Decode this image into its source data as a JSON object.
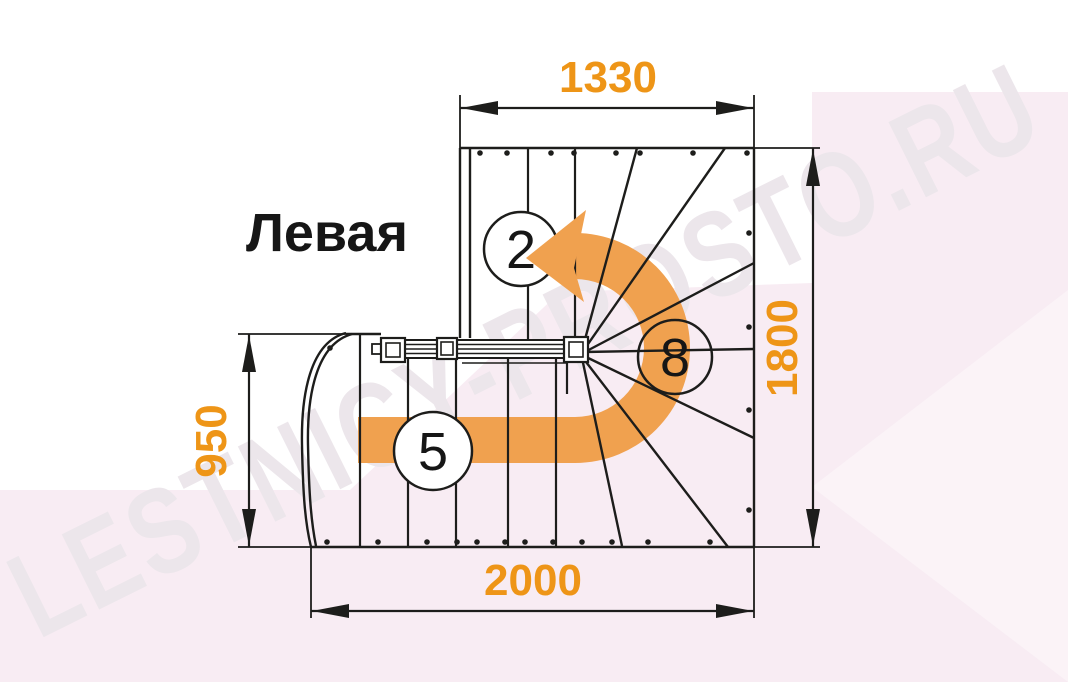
{
  "watermark": {
    "text": "LESTNICY-PROSTO.RU",
    "color": "#ece6eb"
  },
  "drawing": {
    "title": "Левая",
    "dimensions": {
      "top": "1330",
      "right": "1800",
      "left": "950",
      "bottom": "2000"
    },
    "flight_labels": {
      "upper": "2",
      "winders": "8",
      "lower": "5"
    },
    "colors": {
      "dimension_text": "#EE9517",
      "direction_arrow": "#F0A14F",
      "line": "#1d1d1b",
      "background_tint": "#f8ecf3"
    }
  }
}
